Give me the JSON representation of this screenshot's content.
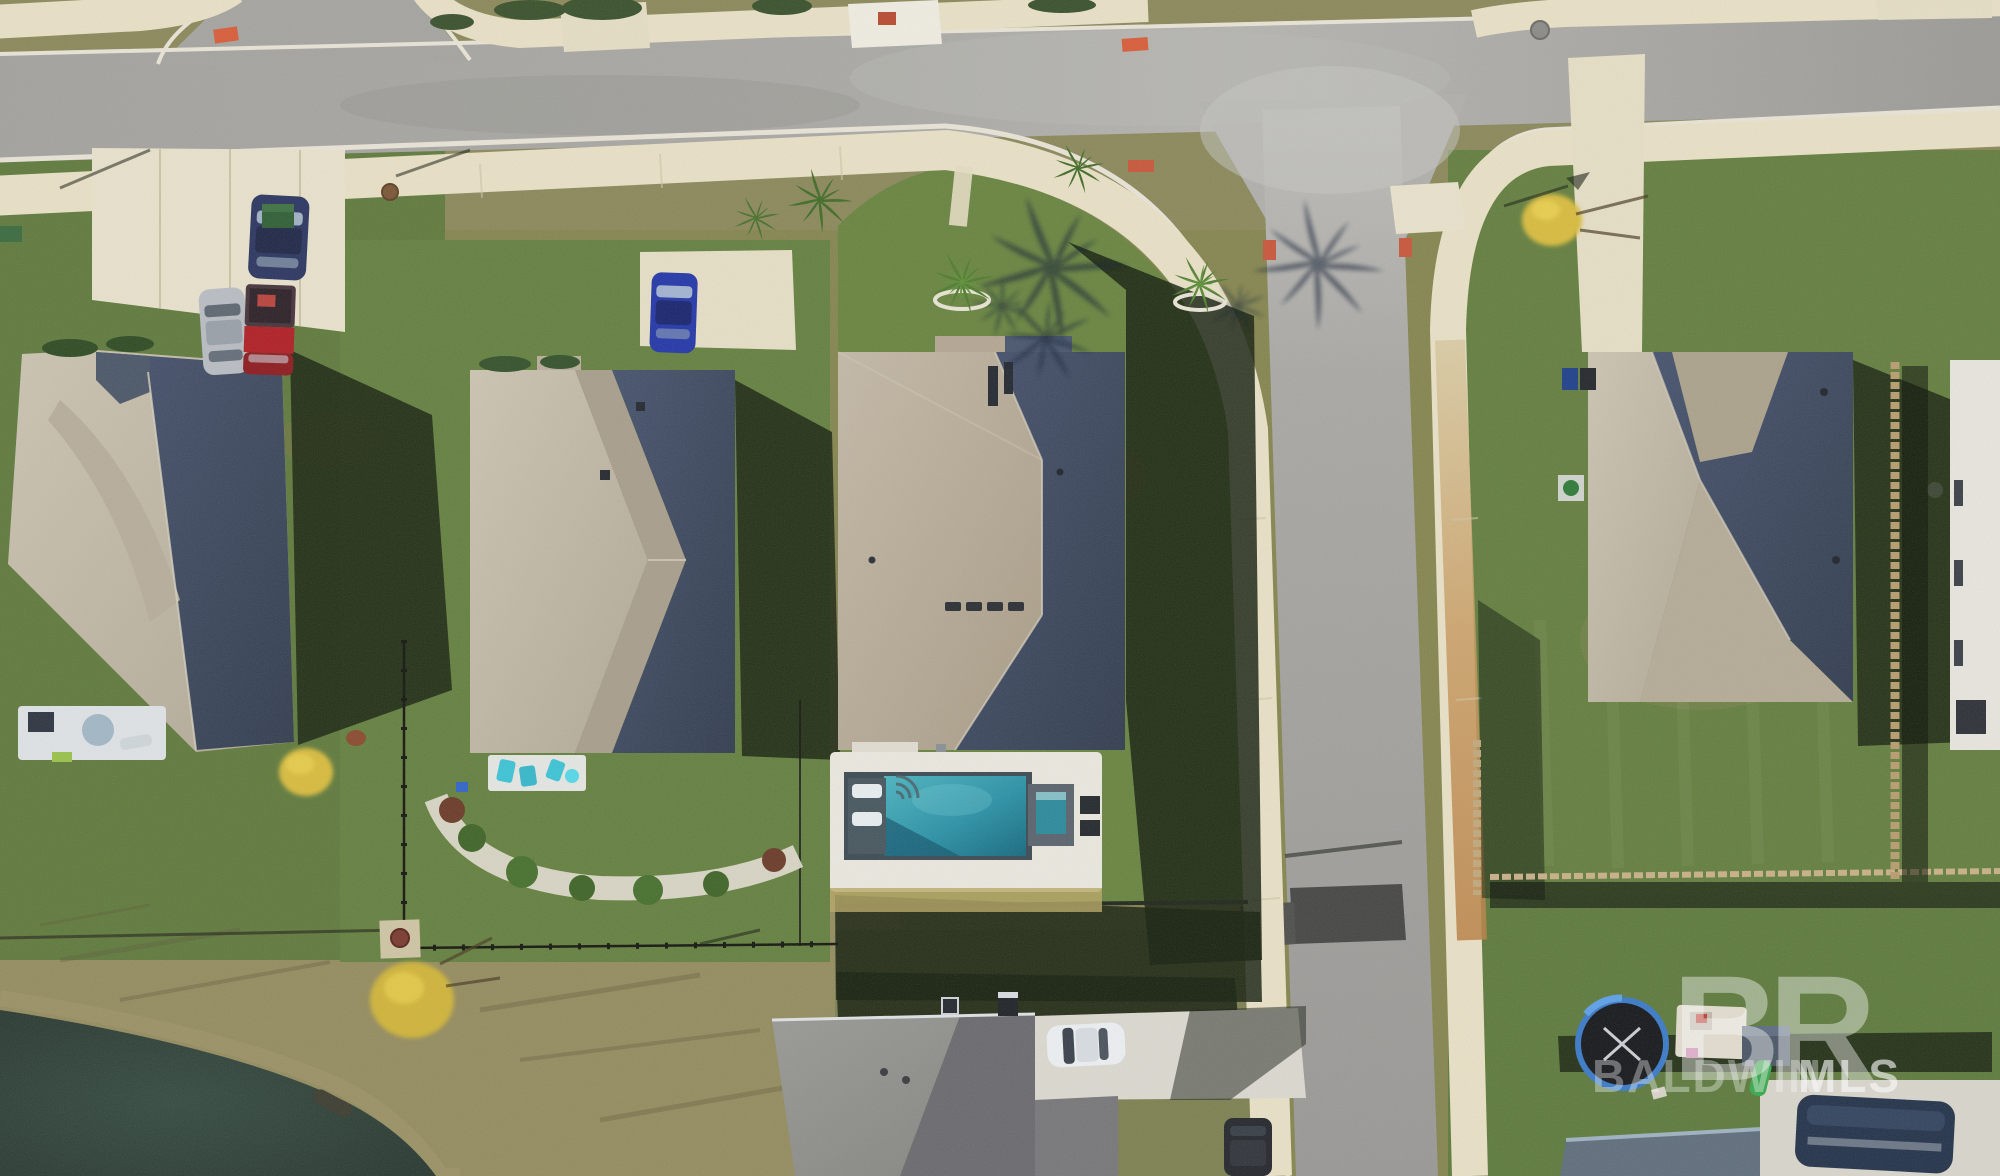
{
  "image": {
    "kind": "aerial-drone-photograph",
    "width_px": 2000,
    "height_px": 1176,
    "description": "Overhead drone photo of a suburban subdivision: a T-intersection of gray asphalt streets with cream sidewalks, four hip-roof homes with tan shingles and shaded east roof planes, a center home with in-ground pool, tanning-ledge loungers and spa, retention pond at lower left, trampoline and play set in a lower-right backyard, long afternoon shadows cast eastward."
  },
  "watermark": {
    "logo_text": "BR",
    "label_text": "BALDWIN",
    "label_bold_text": "MLS",
    "color": "#ffffff"
  },
  "palette": {
    "asphalt": "#9d9d9b",
    "asphalt_patch": "#454543",
    "concrete": "#e8e0c6",
    "concrete_bright": "#f0ede2",
    "curb": "#e9e4d6",
    "grass_sun": "#6b8243",
    "grass_olive": "#8d8a5c",
    "grass_scrub": "#948c5e",
    "cast_shadow": "#16200e",
    "roof_sun_tan": "#c6bdab",
    "roof_shade_blue": "#39455a",
    "pool_water": "#2f97a9",
    "pool_deck": "#ebe8df",
    "pond_water": "#2b3d35",
    "rust_stain": "#c08b4d",
    "wood_fence": "#b89c6e",
    "car_red": "#b01e24",
    "car_navy": "#2b3560",
    "car_bright_blue": "#2336a8",
    "car_silver": "#b9bdc3",
    "car_white": "#edf0f3",
    "suv_dark": "#23262b",
    "utility_green": "#2f5e35",
    "furniture_teal": "#3cc4d6",
    "slide_green": "#39a84c",
    "trampoline_blue": "#3a7ac8",
    "bush_yellow": "#d8bc3c",
    "ada_mat_orange": "#d85c38"
  },
  "scene": {
    "roads": [
      {
        "name": "main-street-horizontal",
        "surface": "asphalt"
      },
      {
        "name": "side-street-vertical",
        "surface": "asphalt"
      },
      {
        "name": "side-street-top-left",
        "surface": "asphalt"
      }
    ],
    "houses": [
      {
        "name": "house-top-left",
        "roof": "tan shingle hip roof, east half shaded, rear patio with umbrella",
        "driveway_cars": 3
      },
      {
        "name": "house-center-left",
        "roof": "tan/gray hip roof, shaded east plane, rear patio with teal chairs",
        "driveway_cars": 1
      },
      {
        "name": "house-center-pool",
        "roof": "tan hip roof with two chimney slots and four ridge vents",
        "pool": true
      },
      {
        "name": "house-right",
        "roof": "tan hip roof with entry courtyard notch, shaded east plane"
      },
      {
        "name": "house-bottom",
        "roof": "gray shingle roof, partially in frame",
        "driveway_cars": 2
      },
      {
        "name": "house-bottom-right",
        "roof": "blue-gray roof sliver at frame edge, boat parked beside"
      }
    ],
    "pool": {
      "water_color": "#2f97a9",
      "features": [
        "white paver deck",
        "tanning ledge",
        "two white loungers",
        "square spa",
        "equipment pads"
      ]
    },
    "pond": {
      "water_color": "#2b3d35",
      "location": "bottom-left",
      "details": [
        "sandy scrub shore",
        "outfall pipe",
        "yellow shrub"
      ]
    },
    "vehicles": [
      {
        "name": "navy-sedan",
        "color": "#2b3560",
        "location": "house-top-left driveway"
      },
      {
        "name": "silver-hatchback",
        "color": "#b9bdc3",
        "location": "house-top-left driveway"
      },
      {
        "name": "red-pickup",
        "color": "#b01e24",
        "location": "house-top-left driveway"
      },
      {
        "name": "blue-sedan",
        "color": "#2336a8",
        "location": "house-center-left driveway"
      },
      {
        "name": "white-sedan",
        "color": "#edf0f3",
        "location": "house-bottom driveway"
      },
      {
        "name": "dark-suv",
        "color": "#23262b",
        "location": "house-bottom driveway near street"
      }
    ],
    "yard_items": [
      "trampoline",
      "play-set-with-green-slide",
      "picnic-table",
      "teal-patio-chairs",
      "patio-umbrella",
      "boat-on-trailer",
      "green-utility-box",
      "trash-bins"
    ],
    "landscape": [
      "palm-trees-with-white-rings",
      "palm-frond-shadows",
      "yellow-shrubs",
      "white-gravel-planting-bed",
      "black-metal-fence",
      "wood-privacy-fences",
      "curb-ramp-orange-mats",
      "manhole-covers"
    ]
  }
}
